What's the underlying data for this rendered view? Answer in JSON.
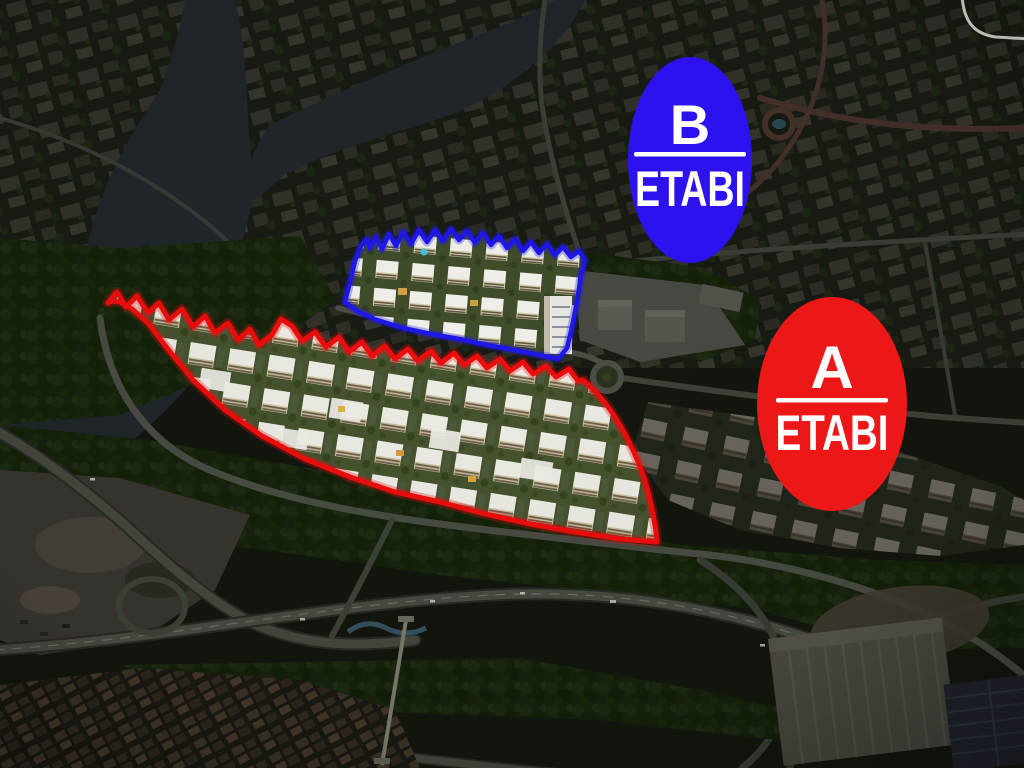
{
  "badges": {
    "phase_b": {
      "letter": "B",
      "name": "ETABI"
    },
    "phase_a": {
      "letter": "A",
      "name": "ETABI"
    }
  },
  "colors": {
    "phase_b_fill": "#2B12EF",
    "phase_a_fill": "#EC1818",
    "phase_b_outline": "#1F17E8",
    "phase_a_outline": "#EE0D0D",
    "divider": "#FFFFFF",
    "badge_text": "#FFFFFF"
  }
}
